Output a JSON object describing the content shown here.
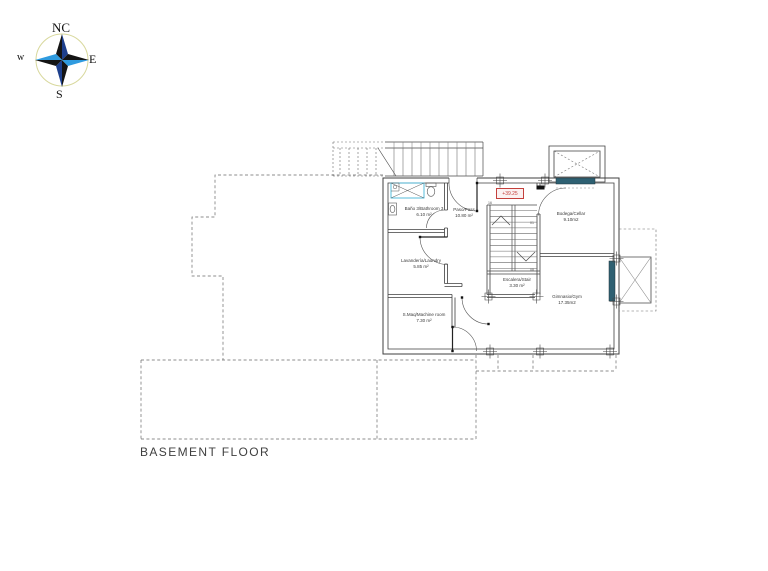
{
  "title": "BASEMENT FLOOR",
  "elevation_marker": "+39.25",
  "compass": {
    "north": "NC",
    "east": "E",
    "south": "S",
    "west": "w"
  },
  "rooms": [
    {
      "name": "Baño 3/Bathroom 3",
      "area": "6.10 m²"
    },
    {
      "name": "Paso/Pass",
      "area": "10.80 m²"
    },
    {
      "name": "Bodega/Cellar",
      "area": "9.10m2"
    },
    {
      "name": "Lavandería/Laundry",
      "area": "5.85 m²"
    },
    {
      "name": "S.Maq/Machine room",
      "area": "7.30 m²"
    },
    {
      "name": "Escalera/Stair",
      "area": "3.30 m²"
    },
    {
      "name": "Gimnasio/Gym",
      "area": "17.35m2"
    }
  ],
  "stair_marks": [
    "16",
    "01",
    "08"
  ],
  "colors": {
    "line": "#3f3f3f",
    "fixture_cyan": "#45b6d8",
    "window_teal": "#2e6072",
    "elevation_red": "#c4403c",
    "compass_blue": "#2f9bdf",
    "compass_navy": "#1d3f8c",
    "compass_black": "#141414",
    "compass_ring": "#d8d89c"
  }
}
